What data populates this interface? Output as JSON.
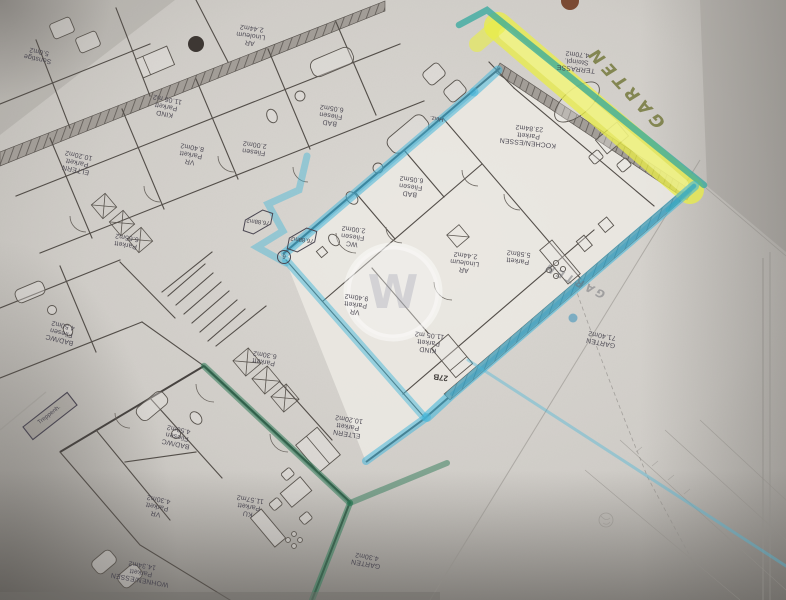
{
  "document": {
    "kind": "scanned floor plan photo",
    "language": "de"
  },
  "rooms": {
    "sonstige": {
      "lines": [
        "Sonstige",
        "5.0m2"
      ]
    },
    "kind_top": {
      "lines": [
        "KIND",
        "Parkett",
        "11.06 m2"
      ]
    },
    "ar_top": {
      "lines": [
        "AR",
        "Linoleum",
        "2.44m2"
      ]
    },
    "bad_top": {
      "lines": [
        "BAD",
        "Fliesen",
        "6.05m2"
      ]
    },
    "wc_top": {
      "lines": [
        "Fliesen",
        "2.00m2"
      ]
    },
    "vr_top": {
      "lines": [
        "VR",
        "Parkett",
        "8.40m2"
      ]
    },
    "eltern_left": {
      "lines": [
        "ELTERN",
        "Parkett",
        "10.20m2"
      ]
    },
    "parkett_665": {
      "lines": [
        "Parkett",
        "6.65m2"
      ]
    },
    "badwc_left": {
      "lines": [
        "BAD/WC",
        "Fliesen",
        "4.50m2"
      ]
    },
    "treppenhaus": {
      "lines": [
        "Treppenh."
      ]
    },
    "heiz": {
      "lines": [
        "Heiz."
      ]
    },
    "bad_unit": {
      "lines": [
        "BAD",
        "Fliesen",
        "6.05m2"
      ]
    },
    "wc_unit": {
      "lines": [
        "WC",
        "Fliesen",
        "2.00m2"
      ]
    },
    "ar_unit": {
      "lines": [
        "AR",
        "Linoleum",
        "2.44m2"
      ]
    },
    "vr_unit": {
      "lines": [
        "VR",
        "Parkett",
        "9.40m2"
      ]
    },
    "kind_unit": {
      "lines": [
        "KIND",
        "Parkett",
        "11.05 m2"
      ]
    },
    "kochen_essen": {
      "lines": [
        "KOCHEN/ESSEN",
        "Parkett",
        "23.84m2"
      ]
    },
    "parkett_558": {
      "lines": [
        "Parkett",
        "5.58m2"
      ]
    },
    "terrasse": {
      "lines": [
        "TERRASSE",
        "Steinpl.",
        "4.70m2"
      ]
    },
    "garten_unit": {
      "lines": [
        "GARTEN",
        "71.40m2"
      ]
    },
    "eltern_bottom": {
      "lines": [
        "ELTERN",
        "Parkett",
        "10.20m2"
      ]
    },
    "parkett_630": {
      "lines": [
        "Parkett",
        "6.30m2"
      ]
    },
    "badwc_bottom": {
      "lines": [
        "BAD/WC",
        "Fliesen",
        "4.50m2"
      ]
    },
    "vr_bottom": {
      "lines": [
        "VR",
        "Parkett",
        "4.30m2"
      ]
    },
    "ku_bottom": {
      "lines": [
        "KU",
        "Parkett",
        "11.57m2"
      ]
    },
    "wohnen_essen": {
      "lines": [
        "WOHNEN/ESSEN",
        "Parkett",
        "14.34m2"
      ]
    },
    "garten_small": {
      "lines": [
        "GARTEN",
        "4.30m2"
      ]
    }
  },
  "annotations": {
    "garden_highlight": "GARTEN",
    "garden_pencil": "GARTEN",
    "house_number": "27B",
    "unit_area_badge": "76.88m2",
    "unit_area_badge2": "76.88m2",
    "unit_number": "6",
    "watermark_letter": "W"
  },
  "markers": {
    "blue": "#45b7da",
    "teal": "#33a89e",
    "green": "#2f7a57",
    "yellow": "#eaf04f",
    "ink": "#44414c"
  }
}
